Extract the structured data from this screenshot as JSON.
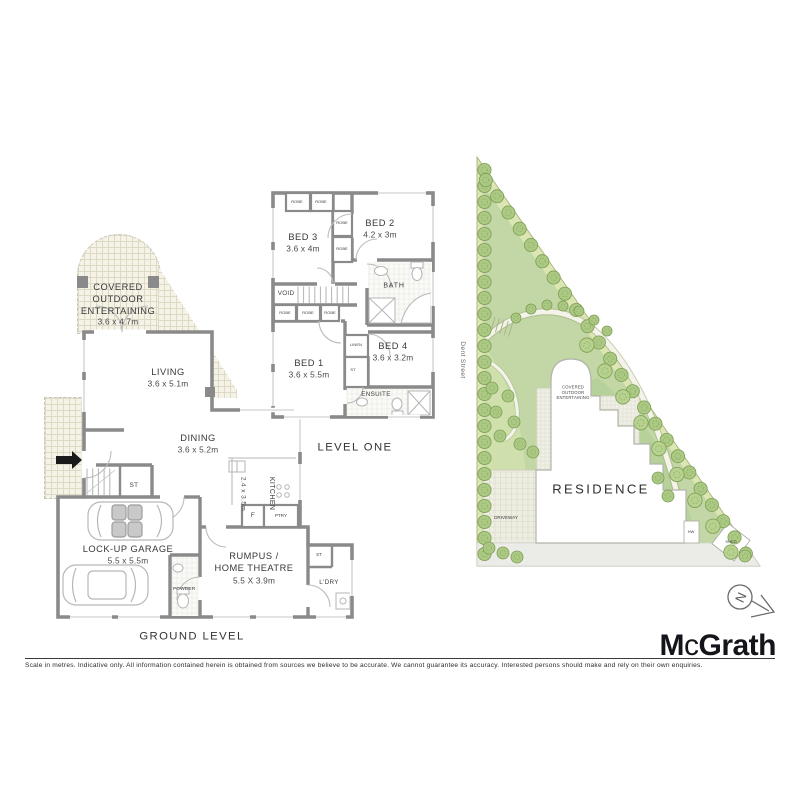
{
  "ground_level": {
    "section_label": "GROUND LEVEL",
    "covered_outdoor": {
      "name": "COVERED\nOUTDOOR\nENTERTAINING",
      "size": "3.6 x 4.7m"
    },
    "living": {
      "name": "LIVING",
      "size": "3.6 x 5.1m"
    },
    "dining": {
      "name": "DINING",
      "size": "3.6 x 5.2m"
    },
    "kitchen": {
      "name": "KITCHEN",
      "size": "2.4 x 3.5m"
    },
    "garage": {
      "name": "LOCK-UP GARAGE",
      "size": "5.5 x 5.5m"
    },
    "rumpus": {
      "name": "RUMPUS /\nHOME THEATRE",
      "size": "5.5 X 3.9m"
    },
    "powder": "POWDER",
    "laundry": "L'DRY",
    "stair_store": "ST",
    "laundry_store": "ST",
    "fridge": "F",
    "pantry": "PTRY"
  },
  "level_one": {
    "section_label": "LEVEL ONE",
    "bed1": {
      "name": "BED 1",
      "size": "3.6 x 5.5m"
    },
    "bed2": {
      "name": "BED 2",
      "size": "4.2 x 3m"
    },
    "bed3": {
      "name": "BED 3",
      "size": "3.6 x 4m"
    },
    "bed4": {
      "name": "BED 4",
      "size": "3.6 x 3.2m"
    },
    "bath": "BATH",
    "ensuite": "ENSUITE",
    "void": "VOID",
    "linen": "LINEN",
    "store": "ST",
    "robe": "ROBE"
  },
  "site_plan": {
    "street_name": "Dent Street",
    "residence_label": "RESIDENCE",
    "covered_outdoor_label": "COVERED\nOUTDOOR\nENTERTAINING",
    "driveway_label": "DRIVEWAY",
    "hot_water_label": "HW",
    "shed_label": "SHED"
  },
  "compass": {
    "north_label": "N"
  },
  "branding": {
    "m": "M",
    "c": "c",
    "grath": "Grath"
  },
  "footer": {
    "disclaimer": "Scale in metres. Indicative only. All information contained herein is obtained from sources we believe to be accurate. We cannot guarantee its accuracy. Interested persons should make and rely on their own enquiries."
  },
  "colors": {
    "wall_gray": "#8a8a8a",
    "lawn_green": "#c2d7a5",
    "border_garden_green": "#dbe6b2",
    "tree_green": "#abc983",
    "band_green": "#b6d199",
    "tile_beige": "#f5f3e8",
    "logo_black": "#14141a"
  }
}
